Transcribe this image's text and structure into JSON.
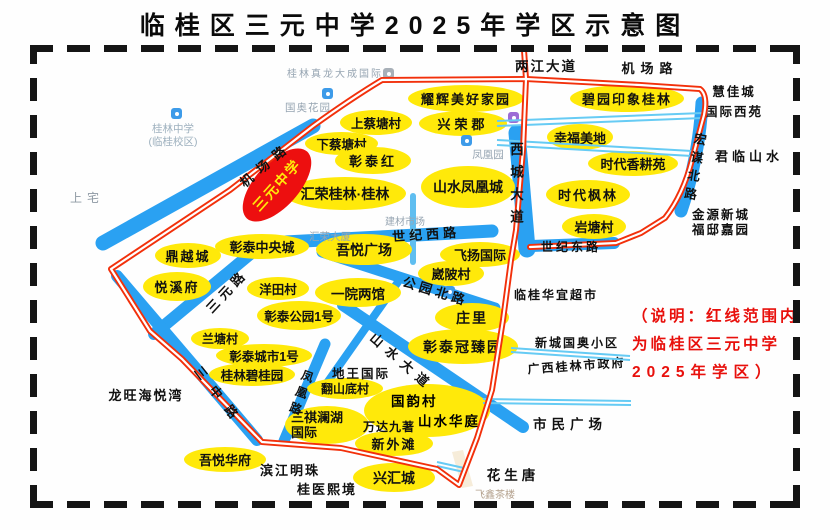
{
  "page": {
    "title": "临桂区三元中学2025年学区示意图"
  },
  "school": {
    "name": "三元中学"
  },
  "note": {
    "line1": "（说明：红线范围内",
    "line2": "为临桂区三元中学",
    "line3": "2025年学区）"
  },
  "roads": {
    "jichang": "机场路",
    "jichang_top": "机场路",
    "liangjiang": "两江大道",
    "xicheng": "西城大道",
    "hongmou": "宏谋北路",
    "shijixi": "世纪西路",
    "shijidong": "世纪东路",
    "gongyuanbei": "公园北路",
    "sanyuan": "三元路",
    "sanzhong": "三中路",
    "fenghuang": "凤凰路",
    "shanshui": "山水大道"
  },
  "estates": {
    "yaohui": "耀辉美好家园",
    "xingrong": "兴荣郡",
    "shangcaitang": "上蔡塘村",
    "xiacaitang": "下蔡塘村",
    "zhangtaihong": "彰泰红",
    "huirong": "汇荣桂林·桂林",
    "fenghuangcheng": "山水凤凰城",
    "biyuan": "碧园印象桂林",
    "xingfu": "幸福美地",
    "xianggeng": "时代香耕苑",
    "fenglin": "时代枫林",
    "yantang": "岩塘村",
    "dingyue": "鼎越城",
    "zhongyangcheng": "彰泰中央城",
    "yuexi": "悦溪府",
    "yangtian": "洋田村",
    "gongyuan1hao": "彰泰公园1号",
    "lantang": "兰塘村",
    "chengshi1hao": "彰泰城市1号",
    "biguiyuan": "桂林碧桂园",
    "wuyue": "吾悦广场",
    "feiyang": "飞扬国际",
    "weipo": "崴陂村",
    "yiyuan": "一院两馆",
    "zhuangli": "庄里",
    "guanzhen": "彰泰冠臻园",
    "fanshandi": "翻山底村",
    "sanqi1": "三祺澜湖",
    "sanqi2": "国际",
    "guoyun": "国韵村",
    "huating": "山水华庭",
    "xinwaitan": "新外滩",
    "xinghui": "兴汇城",
    "wuyuehuafu": "吾悦华府"
  },
  "places": {
    "longwang": "龙旺海悦湾",
    "diwang": "地王国际",
    "wanda": "万达九著",
    "binjiang": "滨江明珠",
    "guiyi": "桂医熙境",
    "huasheng": "花生唐",
    "shimin": "市民广场",
    "junlin": "君临山水",
    "huijia1": "慧佳城",
    "huijia2": "国际西苑",
    "jinyuan1": "金源新城",
    "jinyuan2": "福邸嘉园",
    "huayi": "临桂华宜超市",
    "guoao_xq": "新城国奥小区",
    "zhengfu": "广西桂林市政府"
  },
  "poi": {
    "gzx1": "桂林中学",
    "gzx2": "(临桂校区)",
    "shangzhai": "上宅",
    "guoaohy": "国奥花园",
    "zhenlong": "桂林真龙大成国际",
    "fhy": "凤凰园",
    "hrds": "汇荣大厦",
    "jiancai": "建材市场",
    "feixin": "飞鑫茶楼"
  },
  "colors": {
    "boundary_red": "#F2300B",
    "road_blue": "#2AA1F2",
    "minor_road_blue": "#66CBF4",
    "estate_yellow": "#FFE90A",
    "school_red": "#ED0F0F",
    "note_red": "#E8100C",
    "border_black": "#151515"
  }
}
